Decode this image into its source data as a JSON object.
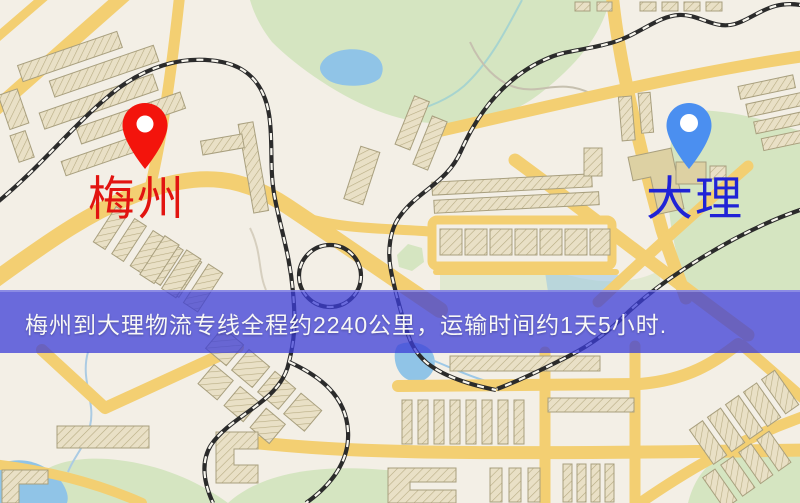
{
  "page": {
    "width": 800,
    "height": 503,
    "kind": "logistics route map image"
  },
  "markers": {
    "origin": {
      "label": "梅州",
      "label_color": "#e21410",
      "pin_color": "#f3140c"
    },
    "destination": {
      "label": "大理",
      "label_color": "#2023d6",
      "pin_color": "#4b8ff0"
    }
  },
  "banner": {
    "text": "梅州到大理物流专线全程约2240公里，运输时间约1天5小时.",
    "background": "#3c3ed7",
    "text_color": "#f7f7f7",
    "distance_km": "2240",
    "duration": "1天5小时"
  },
  "map_colors": {
    "background": "#f3efe6",
    "road": "#f4cf6f",
    "building": "#ebe2c8",
    "park": "#d5e5c0",
    "water": "#8fc4e8",
    "railway": "#2b2b2b"
  }
}
